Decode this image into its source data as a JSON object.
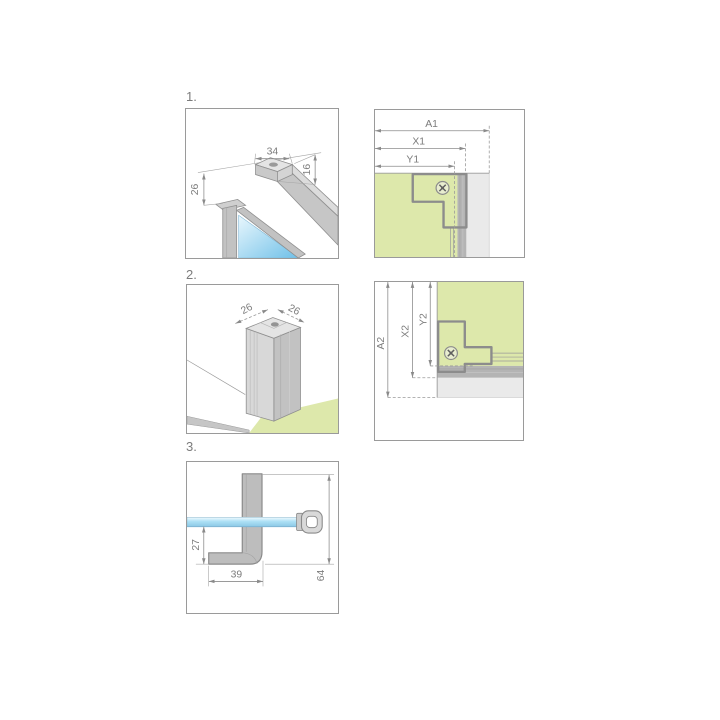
{
  "steps": {
    "s1": "1.",
    "s2": "2.",
    "s3": "3."
  },
  "panel1": {
    "dim_bar_width": "34",
    "dim_bar_height": "16",
    "dim_offset": "26"
  },
  "panel2": {
    "dim_a1": "A1",
    "dim_x1": "X1",
    "dim_y1": "Y1"
  },
  "panel3": {
    "dim_left": "26",
    "dim_right": "26"
  },
  "panel4": {
    "dim_a2": "A2",
    "dim_x2": "X2",
    "dim_y2": "Y2"
  },
  "panel5": {
    "dim_glass_to_foot": "27",
    "dim_foot_length": "39",
    "dim_bracket_height": "64"
  },
  "colors": {
    "wall_green": "#dde8ab",
    "glass_blue": "#a9daf2",
    "profile_gray": "#b4b4b4",
    "wall_gray": "#eaeaea",
    "outline_gray": "#8c8c8c",
    "dim_gray": "#7c7c7c"
  }
}
